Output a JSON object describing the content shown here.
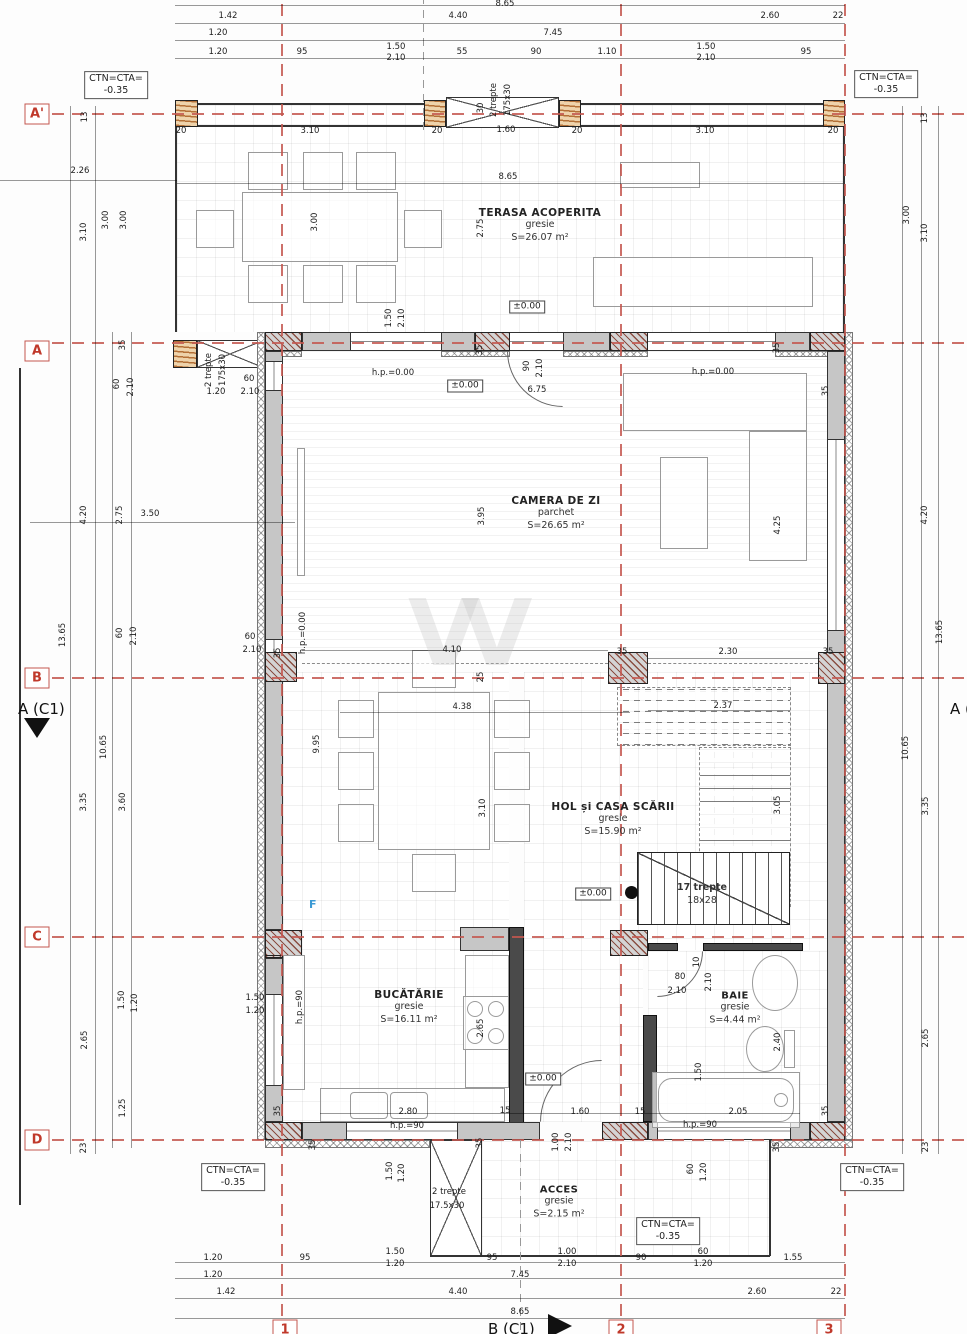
{
  "axes": {
    "rows": [
      {
        "label": "A'"
      },
      {
        "label": "A"
      },
      {
        "label": "B"
      },
      {
        "label": "C"
      },
      {
        "label": "D"
      }
    ],
    "cols": [
      {
        "label": "1"
      },
      {
        "label": "2"
      },
      {
        "label": "3"
      }
    ]
  },
  "section_markers": {
    "left": "A (C1)",
    "right": "A (C1)",
    "bottom": "B (C1)"
  },
  "level_boxes": [
    {
      "line1": "CTN=CTA=",
      "line2": "-0.35"
    },
    {
      "line1": "CTN=CTA=",
      "line2": "-0.35"
    },
    {
      "line1": "CTN=CTA=",
      "line2": "-0.35"
    },
    {
      "line1": "CTN=CTA=",
      "line2": "-0.35"
    },
    {
      "line1": "CTN=CTA=",
      "line2": "-0.35"
    }
  ],
  "rooms": [
    {
      "name": "TERASA ACOPERITA",
      "finish": "gresie",
      "area": "S=26.07 m²"
    },
    {
      "name": "CAMERA DE ZI",
      "finish": "parchet",
      "area": "S=26.65 m²"
    },
    {
      "name": "HOL și CASA SCĂRII",
      "finish": "gresie",
      "area": "S=15.90 m²"
    },
    {
      "name": "BUCĂTĂRIE",
      "finish": "gresie",
      "area": "S=16.11 m²"
    },
    {
      "name": "BAIE",
      "finish": "gresie",
      "area": "S=4.44 m²"
    },
    {
      "name": "ACCES",
      "finish": "gresie",
      "area": "S=2.15 m²"
    }
  ],
  "stairs": {
    "count": "17 trepte",
    "size": "18x28"
  },
  "annotations": {
    "f_label": "F"
  },
  "dim_labels": [
    {
      "t": "8.65",
      "x": 505,
      "y": 4
    },
    {
      "t": "1.42",
      "x": 228,
      "y": 16
    },
    {
      "t": "4.40",
      "x": 458,
      "y": 16
    },
    {
      "t": "2.60",
      "x": 770,
      "y": 16
    },
    {
      "t": "22",
      "x": 838,
      "y": 16
    },
    {
      "t": "1.20",
      "x": 218,
      "y": 33
    },
    {
      "t": "7.45",
      "x": 553,
      "y": 33
    },
    {
      "t": "1.20",
      "x": 218,
      "y": 52
    },
    {
      "t": "95",
      "x": 302,
      "y": 52
    },
    {
      "t": "1.50",
      "x": 396,
      "y": 47
    },
    {
      "t": "2.10",
      "x": 396,
      "y": 58
    },
    {
      "t": "55",
      "x": 462,
      "y": 52
    },
    {
      "t": "90",
      "x": 536,
      "y": 52
    },
    {
      "t": "1.10",
      "x": 607,
      "y": 52
    },
    {
      "t": "1.50",
      "x": 706,
      "y": 47
    },
    {
      "t": "2.10",
      "x": 706,
      "y": 58
    },
    {
      "t": "95",
      "x": 806,
      "y": 52
    },
    {
      "t": "20",
      "x": 181,
      "y": 131
    },
    {
      "t": "3.10",
      "x": 310,
      "y": 131
    },
    {
      "t": "20",
      "x": 437,
      "y": 131
    },
    {
      "t": "1.60",
      "x": 506,
      "y": 130
    },
    {
      "t": "20",
      "x": 577,
      "y": 131
    },
    {
      "t": "3.10",
      "x": 705,
      "y": 131
    },
    {
      "t": "20",
      "x": 833,
      "y": 131
    },
    {
      "t": "2 trepte",
      "x": 494,
      "y": 100,
      "r": 1
    },
    {
      "t": "175x30",
      "x": 508,
      "y": 100,
      "r": 1
    },
    {
      "t": "30",
      "x": 481,
      "y": 108,
      "r": 1
    },
    {
      "t": "8.65",
      "x": 508,
      "y": 177
    },
    {
      "t": "3.00",
      "x": 315,
      "y": 222,
      "r": 1
    },
    {
      "t": "2.75",
      "x": 481,
      "y": 228,
      "r": 1
    },
    {
      "t": "1.50",
      "x": 389,
      "y": 318,
      "r": 1
    },
    {
      "t": "2.10",
      "x": 402,
      "y": 318,
      "r": 1
    },
    {
      "t": "13",
      "x": 85,
      "y": 117,
      "r": 1
    },
    {
      "t": "2.26",
      "x": 80,
      "y": 171
    },
    {
      "t": "3.10",
      "x": 84,
      "y": 232,
      "r": 1
    },
    {
      "t": "3.00",
      "x": 106,
      "y": 220,
      "r": 1
    },
    {
      "t": "3.00",
      "x": 124,
      "y": 220,
      "r": 1
    },
    {
      "t": "35",
      "x": 123,
      "y": 345,
      "r": 1
    },
    {
      "t": "60",
      "x": 117,
      "y": 384,
      "r": 1
    },
    {
      "t": "2.10",
      "x": 131,
      "y": 387,
      "r": 1
    },
    {
      "t": "4.20",
      "x": 84,
      "y": 515,
      "r": 1
    },
    {
      "t": "2.75",
      "x": 120,
      "y": 515,
      "r": 1
    },
    {
      "t": "3.50",
      "x": 150,
      "y": 514
    },
    {
      "t": "13.65",
      "x": 63,
      "y": 635,
      "r": 1
    },
    {
      "t": "60",
      "x": 120,
      "y": 633,
      "r": 1
    },
    {
      "t": "2.10",
      "x": 134,
      "y": 636,
      "r": 1
    },
    {
      "t": "10.65",
      "x": 104,
      "y": 747,
      "r": 1
    },
    {
      "t": "3.35",
      "x": 84,
      "y": 802,
      "r": 1
    },
    {
      "t": "3.60",
      "x": 123,
      "y": 802,
      "r": 1
    },
    {
      "t": "1.50",
      "x": 122,
      "y": 1000,
      "r": 1
    },
    {
      "t": "1.20",
      "x": 135,
      "y": 1003,
      "r": 1
    },
    {
      "t": "2.65",
      "x": 85,
      "y": 1040,
      "r": 1
    },
    {
      "t": "1.25",
      "x": 123,
      "y": 1108,
      "r": 1
    },
    {
      "t": "23",
      "x": 84,
      "y": 1148,
      "r": 1
    },
    {
      "t": "13",
      "x": 925,
      "y": 118,
      "r": 1
    },
    {
      "t": "3.00",
      "x": 907,
      "y": 215,
      "r": 1
    },
    {
      "t": "3.10",
      "x": 925,
      "y": 233,
      "r": 1
    },
    {
      "t": "4.20",
      "x": 925,
      "y": 515,
      "r": 1
    },
    {
      "t": "13.65",
      "x": 940,
      "y": 632,
      "r": 1
    },
    {
      "t": "10.65",
      "x": 906,
      "y": 748,
      "r": 1
    },
    {
      "t": "3.35",
      "x": 926,
      "y": 806,
      "r": 1
    },
    {
      "t": "2.65",
      "x": 926,
      "y": 1038,
      "r": 1
    },
    {
      "t": "23",
      "x": 926,
      "y": 1147,
      "r": 1
    },
    {
      "t": "22",
      "x": 836,
      "y": 1292
    },
    {
      "t": "2 trepte",
      "x": 209,
      "y": 370,
      "r": 1
    },
    {
      "t": "175x30",
      "x": 223,
      "y": 370,
      "r": 1
    },
    {
      "t": "1.20",
      "x": 216,
      "y": 392
    },
    {
      "t": "60",
      "x": 249,
      "y": 379
    },
    {
      "t": "2.10",
      "x": 250,
      "y": 392
    },
    {
      "t": "35",
      "x": 480,
      "y": 350,
      "r": 1
    },
    {
      "t": "35",
      "x": 777,
      "y": 348,
      "r": 1
    },
    {
      "t": "35",
      "x": 826,
      "y": 391,
      "r": 1
    },
    {
      "t": "h.p.=0.00",
      "x": 393,
      "y": 373
    },
    {
      "t": "h.p.=0.00",
      "x": 713,
      "y": 372
    },
    {
      "t": "90",
      "x": 527,
      "y": 366,
      "r": 1
    },
    {
      "t": "2.10",
      "x": 540,
      "y": 368,
      "r": 1
    },
    {
      "t": "6.75",
      "x": 537,
      "y": 390
    },
    {
      "t": "3.95",
      "x": 482,
      "y": 516,
      "r": 1
    },
    {
      "t": "4.25",
      "x": 778,
      "y": 525,
      "r": 1
    },
    {
      "t": "60",
      "x": 250,
      "y": 637
    },
    {
      "t": "2.10",
      "x": 252,
      "y": 650
    },
    {
      "t": "h.p.=0.00",
      "x": 303,
      "y": 633,
      "r": 1
    },
    {
      "t": "35",
      "x": 278,
      "y": 653,
      "r": 1
    },
    {
      "t": "4.10",
      "x": 452,
      "y": 650
    },
    {
      "t": "25",
      "x": 481,
      "y": 677,
      "r": 1
    },
    {
      "t": "4.38",
      "x": 462,
      "y": 707
    },
    {
      "t": "35",
      "x": 622,
      "y": 652
    },
    {
      "t": "2.30",
      "x": 728,
      "y": 652
    },
    {
      "t": "35",
      "x": 828,
      "y": 652
    },
    {
      "t": "2.37",
      "x": 723,
      "y": 706
    },
    {
      "t": "9.95",
      "x": 317,
      "y": 744,
      "r": 1
    },
    {
      "t": "3.10",
      "x": 483,
      "y": 808,
      "r": 1
    },
    {
      "t": "3.05",
      "x": 778,
      "y": 805,
      "r": 1
    },
    {
      "t": "1.50",
      "x": 255,
      "y": 998
    },
    {
      "t": "1.20",
      "x": 255,
      "y": 1011
    },
    {
      "t": "h.p.=90",
      "x": 300,
      "y": 1007,
      "r": 1
    },
    {
      "t": "2.65",
      "x": 481,
      "y": 1028,
      "r": 1
    },
    {
      "t": "2.80",
      "x": 408,
      "y": 1112
    },
    {
      "t": "h.p.=90",
      "x": 407,
      "y": 1126
    },
    {
      "t": "15",
      "x": 505,
      "y": 1111
    },
    {
      "t": "1.60",
      "x": 580,
      "y": 1112
    },
    {
      "t": "35",
      "x": 278,
      "y": 1111,
      "r": 1
    },
    {
      "t": "35",
      "x": 313,
      "y": 1145,
      "r": 1
    },
    {
      "t": "35",
      "x": 480,
      "y": 1143,
      "r": 1
    },
    {
      "t": "1.00",
      "x": 556,
      "y": 1142,
      "r": 1
    },
    {
      "t": "2.10",
      "x": 569,
      "y": 1142,
      "r": 1
    },
    {
      "t": "80",
      "x": 680,
      "y": 977
    },
    {
      "t": "2.10",
      "x": 677,
      "y": 991
    },
    {
      "t": "2.10",
      "x": 709,
      "y": 982,
      "r": 1
    },
    {
      "t": "10",
      "x": 697,
      "y": 962,
      "r": 1
    },
    {
      "t": "2.40",
      "x": 778,
      "y": 1042,
      "r": 1
    },
    {
      "t": "1.50",
      "x": 699,
      "y": 1072,
      "r": 1
    },
    {
      "t": "2.05",
      "x": 738,
      "y": 1112
    },
    {
      "t": "15",
      "x": 640,
      "y": 1112
    },
    {
      "t": "h.p.=90",
      "x": 700,
      "y": 1125
    },
    {
      "t": "35",
      "x": 826,
      "y": 1111,
      "r": 1
    },
    {
      "t": "35",
      "x": 777,
      "y": 1147,
      "r": 1
    },
    {
      "t": "1.50",
      "x": 390,
      "y": 1171,
      "r": 1
    },
    {
      "t": "1.20",
      "x": 402,
      "y": 1173,
      "r": 1
    },
    {
      "t": "60",
      "x": 691,
      "y": 1169,
      "r": 1
    },
    {
      "t": "1.20",
      "x": 704,
      "y": 1172,
      "r": 1
    },
    {
      "t": "2 trepte",
      "x": 449,
      "y": 1192
    },
    {
      "t": "17.5x30",
      "x": 447,
      "y": 1206
    },
    {
      "t": "1.20",
      "x": 213,
      "y": 1258
    },
    {
      "t": "95",
      "x": 305,
      "y": 1258
    },
    {
      "t": "1.50",
      "x": 395,
      "y": 1252
    },
    {
      "t": "1.20",
      "x": 395,
      "y": 1264
    },
    {
      "t": "95",
      "x": 492,
      "y": 1258
    },
    {
      "t": "1.00",
      "x": 567,
      "y": 1252
    },
    {
      "t": "2.10",
      "x": 567,
      "y": 1264
    },
    {
      "t": "90",
      "x": 641,
      "y": 1258
    },
    {
      "t": "60",
      "x": 703,
      "y": 1252
    },
    {
      "t": "1.20",
      "x": 703,
      "y": 1264
    },
    {
      "t": "1.55",
      "x": 793,
      "y": 1258
    },
    {
      "t": "1.20",
      "x": 213,
      "y": 1275
    },
    {
      "t": "7.45",
      "x": 520,
      "y": 1275
    },
    {
      "t": "1.42",
      "x": 226,
      "y": 1292
    },
    {
      "t": "4.40",
      "x": 458,
      "y": 1292
    },
    {
      "t": "2.60",
      "x": 757,
      "y": 1292
    },
    {
      "t": "8.65",
      "x": 520,
      "y": 1312
    },
    {
      "t": "±0.00",
      "x": 527,
      "y": 307,
      "b": 1
    },
    {
      "t": "±0.00",
      "x": 465,
      "y": 386,
      "b": 1
    },
    {
      "t": "±0.00",
      "x": 593,
      "y": 894,
      "b": 1
    },
    {
      "t": "±0.00",
      "x": 543,
      "y": 1079,
      "b": 1
    }
  ]
}
